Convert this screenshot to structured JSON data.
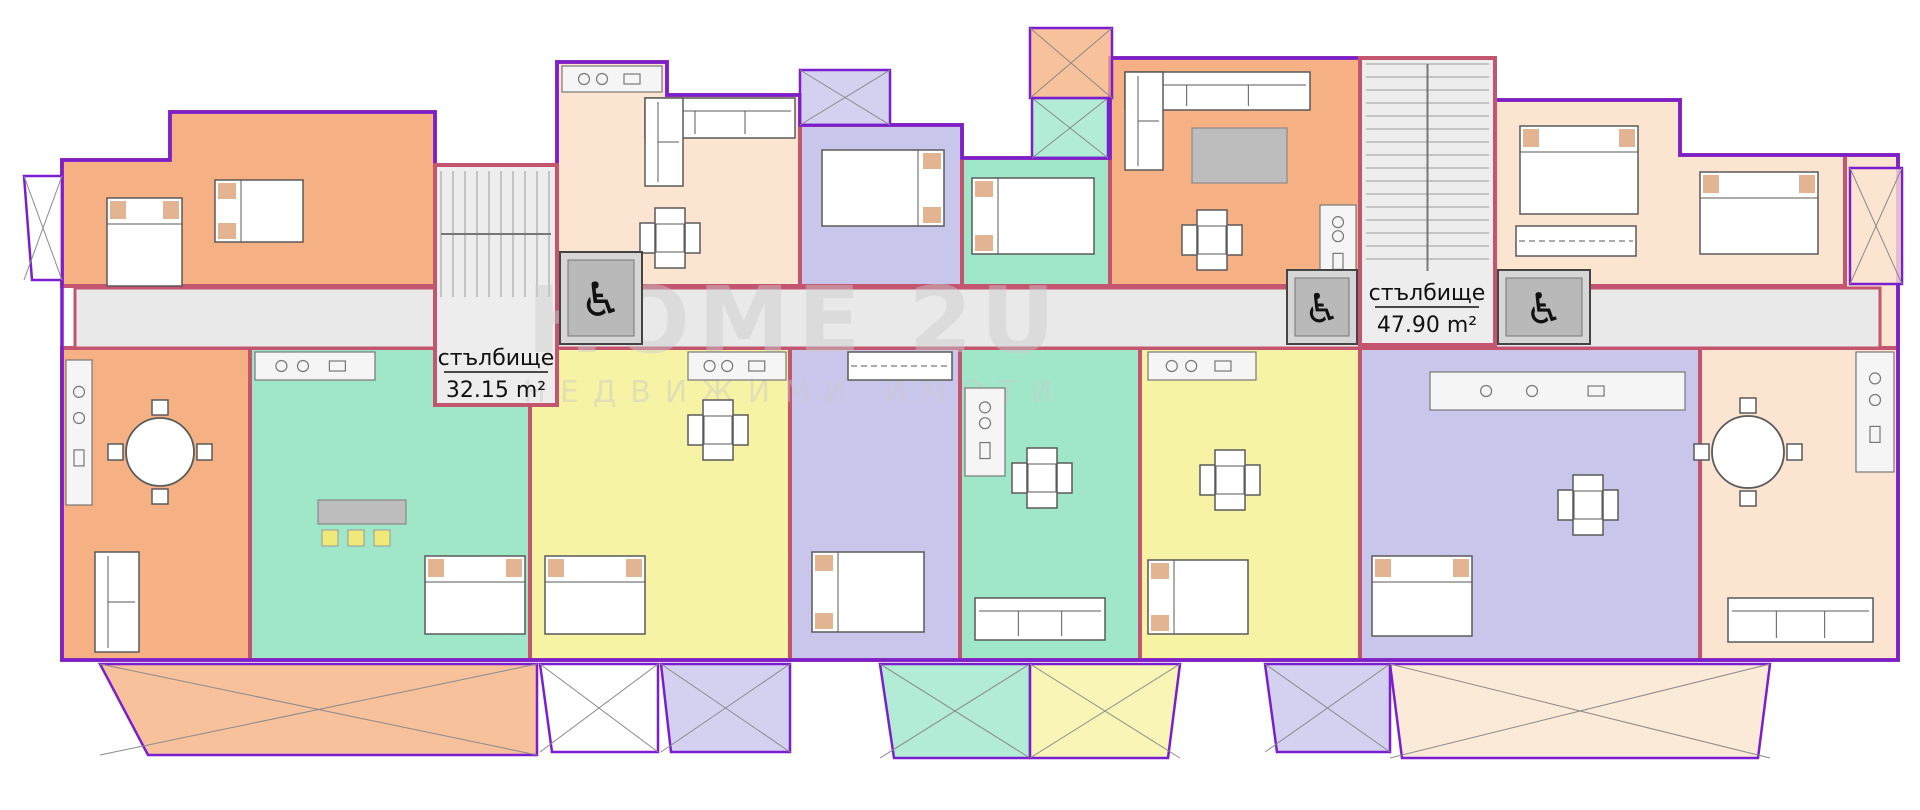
{
  "watermark": {
    "line1": "HOME 2U",
    "line2": "НЕДВИЖИМИ ИМОТИ"
  },
  "labels": {
    "staircase_left": {
      "name": "стълбище",
      "area": "32.15 m²"
    },
    "staircase_right": {
      "name": "стълбище",
      "area": "47.90 m²"
    }
  },
  "icons": {
    "wheelchair": "♿"
  },
  "colors": {
    "wall": "#c4556f",
    "outline": "#7a1fd0",
    "corridor": "#e9e9e9",
    "core": "#ededed",
    "tread": "#9a9a9a",
    "orange": "#f5b183",
    "cream": "#fbe5d0",
    "lavender": "#c9c6ec",
    "teal": "#a0e7c9",
    "yellow": "#f7f3a5",
    "white": "#ffffff",
    "elevator": "#d6d6d6",
    "elevator_inner": "#b9b9b9",
    "furniture_gray": "#bdbdbd",
    "chair_yellow": "#f0e97a"
  },
  "plan": {
    "outline": "M62,160 H170 V112 H435 V165 H557 V62 H667 V95 H800 V125 H962 V158 H1110 V58 H1495 V100 H1680 V155 H1898 V660 H62 Z",
    "corridor": {
      "name": "corridor",
      "points": "75,288 1880,288 1880,348 75,348"
    },
    "regions": [
      {
        "name": "apt-orange-top-left",
        "color": "orange",
        "points": "62,160 170,160 170,112 435,112 435,286 62,286"
      },
      {
        "name": "apt-cream-top-center",
        "color": "cream",
        "points": "557,62 667,62 667,95 800,95 800,286 557,286"
      },
      {
        "name": "apt-lavender-top-center",
        "color": "lavender",
        "points": "800,125 962,125 962,286 800,286"
      },
      {
        "name": "apt-teal-top-center",
        "color": "teal",
        "points": "962,158 1110,158 1110,286 962,286"
      },
      {
        "name": "apt-orange-top-right",
        "color": "orange",
        "points": "1110,58 1360,58 1360,286 1110,286"
      },
      {
        "name": "apt-cream-top-right",
        "color": "cream",
        "points": "1495,100 1680,100 1680,155 1845,155 1845,286 1495,286"
      },
      {
        "name": "apt-cream-right-wing",
        "color": "cream",
        "points": "1845,155 1898,155 1898,348 1845,348"
      },
      {
        "name": "apt-orange-bottom-left",
        "color": "orange",
        "points": "62,348 250,348 250,660 62,660"
      },
      {
        "name": "apt-teal-bottom-left",
        "color": "teal",
        "points": "250,348 530,348 530,660 250,660"
      },
      {
        "name": "apt-yellow-bottom-left",
        "color": "yellow",
        "points": "530,348 790,348 790,660 530,660"
      },
      {
        "name": "apt-lavender-bottom-center-left",
        "color": "lavender",
        "points": "790,348 960,348 960,660 790,660"
      },
      {
        "name": "apt-teal-bottom-center",
        "color": "teal",
        "points": "960,348 1140,348 1140,660 960,660"
      },
      {
        "name": "apt-yellow-bottom-center",
        "color": "yellow",
        "points": "1140,348 1360,348 1360,660 1140,660"
      },
      {
        "name": "apt-lavender-bottom-right",
        "color": "lavender",
        "points": "1360,348 1700,348 1700,660 1360,660"
      },
      {
        "name": "apt-cream-bottom-right",
        "color": "cream",
        "points": "1700,348 1898,348 1898,660 1700,660"
      }
    ],
    "balconies": [
      {
        "name": "balcony-orange-left",
        "color": "orange",
        "points": "100,664 537,664 537,755 148,755"
      },
      {
        "name": "balcony-white-1",
        "color": "white",
        "points": "540,664 658,664 658,752 552,752"
      },
      {
        "name": "balcony-lavender-1",
        "color": "lavender",
        "points": "661,664 790,664 790,752 671,752"
      },
      {
        "name": "balcony-teal-center",
        "color": "teal",
        "points": "880,664 1030,664 1030,758 894,758"
      },
      {
        "name": "balcony-yellow-center",
        "color": "yellow",
        "points": "1030,664 1180,664 1168,758 1030,758"
      },
      {
        "name": "balcony-lavender-2",
        "color": "lavender",
        "points": "1265,664 1390,664 1390,752 1277,752"
      },
      {
        "name": "balcony-cream-right",
        "color": "cream",
        "points": "1390,664 1770,664 1758,758 1402,758"
      },
      {
        "name": "terrace-lavender-top",
        "color": "lavender",
        "points": "800,70 890,70 890,125 800,125"
      },
      {
        "name": "terrace-teal-top",
        "color": "teal",
        "points": "1032,98 1108,98 1108,158 1032,158"
      },
      {
        "name": "terrace-orange-top",
        "color": "orange",
        "points": "1030,28 1112,28 1112,98 1030,98"
      },
      {
        "name": "balcony-cream-right-edge",
        "color": "cream",
        "points": "1850,168 1902,168 1902,284 1850,284"
      },
      {
        "name": "balcony-white-left-edge",
        "color": "white",
        "points": "24,176 62,176 62,280 32,280"
      }
    ],
    "cores": [
      {
        "name": "staircase-left",
        "x": 435,
        "y": 165,
        "w": 122,
        "h": 240,
        "stairs": {
          "x": 441,
          "y": 171,
          "w": 110,
          "h": 126,
          "dir": "v",
          "step": 12
        }
      },
      {
        "name": "staircase-right",
        "x": 1360,
        "y": 58,
        "w": 135,
        "h": 287,
        "stairs": {
          "x": 1366,
          "y": 64,
          "w": 123,
          "h": 207,
          "dir": "h",
          "step": 13
        }
      }
    ],
    "elevators": [
      {
        "name": "elevator-left",
        "x": 560,
        "y": 252,
        "w": 82,
        "h": 92
      },
      {
        "name": "elevator-right-1",
        "x": 1287,
        "y": 270,
        "w": 70,
        "h": 74
      },
      {
        "name": "elevator-right-2",
        "x": 1498,
        "y": 270,
        "w": 92,
        "h": 74
      }
    ],
    "furniture": [
      {
        "type": "bed",
        "x": 107,
        "y": 198,
        "w": 75,
        "h": 88,
        "head": "top"
      },
      {
        "type": "bed",
        "x": 215,
        "y": 180,
        "w": 88,
        "h": 62,
        "head": "left"
      },
      {
        "type": "bed",
        "x": 822,
        "y": 150,
        "w": 122,
        "h": 76,
        "head": "right"
      },
      {
        "type": "bed",
        "x": 972,
        "y": 178,
        "w": 122,
        "h": 76,
        "head": "left"
      },
      {
        "type": "bed",
        "x": 1520,
        "y": 126,
        "w": 118,
        "h": 88,
        "head": "top"
      },
      {
        "type": "bed",
        "x": 1700,
        "y": 172,
        "w": 118,
        "h": 82,
        "head": "top"
      },
      {
        "type": "bed",
        "x": 425,
        "y": 556,
        "w": 100,
        "h": 78,
        "head": "top"
      },
      {
        "type": "bed",
        "x": 545,
        "y": 556,
        "w": 100,
        "h": 78,
        "head": "top"
      },
      {
        "type": "bed",
        "x": 1148,
        "y": 560,
        "w": 100,
        "h": 74,
        "head": "left"
      },
      {
        "type": "bed",
        "x": 1372,
        "y": 556,
        "w": 100,
        "h": 80,
        "head": "top"
      },
      {
        "type": "bed",
        "x": 812,
        "y": 552,
        "w": 112,
        "h": 80,
        "head": "left"
      },
      {
        "type": "sofa",
        "x": 645,
        "y": 98,
        "w": 150,
        "h": 40
      },
      {
        "type": "sofa",
        "x": 645,
        "y": 98,
        "w": 38,
        "h": 88
      },
      {
        "type": "sofa",
        "x": 1125,
        "y": 72,
        "w": 185,
        "h": 38
      },
      {
        "type": "sofa",
        "x": 1125,
        "y": 72,
        "w": 38,
        "h": 98
      },
      {
        "type": "sofa",
        "x": 95,
        "y": 552,
        "w": 44,
        "h": 100
      },
      {
        "type": "sofa",
        "x": 975,
        "y": 598,
        "w": 130,
        "h": 42
      },
      {
        "type": "sofa",
        "x": 1728,
        "y": 598,
        "w": 145,
        "h": 44
      },
      {
        "type": "kitchen",
        "x": 562,
        "y": 66,
        "w": 100,
        "h": 26
      },
      {
        "type": "kitchen",
        "x": 1320,
        "y": 205,
        "w": 36,
        "h": 78
      },
      {
        "type": "kitchen",
        "x": 66,
        "y": 360,
        "w": 26,
        "h": 145
      },
      {
        "type": "kitchen",
        "x": 255,
        "y": 352,
        "w": 120,
        "h": 28
      },
      {
        "type": "kitchen",
        "x": 688,
        "y": 352,
        "w": 98,
        "h": 28
      },
      {
        "type": "kitchen",
        "x": 965,
        "y": 388,
        "w": 40,
        "h": 88
      },
      {
        "type": "kitchen",
        "x": 1148,
        "y": 352,
        "w": 108,
        "h": 28
      },
      {
        "type": "kitchen",
        "x": 1430,
        "y": 372,
        "w": 255,
        "h": 38
      },
      {
        "type": "kitchen",
        "x": 1856,
        "y": 352,
        "w": 38,
        "h": 120
      },
      {
        "type": "rtable",
        "cx": 160,
        "cy": 452,
        "r": 34
      },
      {
        "type": "rtable",
        "cx": 1748,
        "cy": 452,
        "r": 36
      },
      {
        "type": "xtable",
        "cx": 670,
        "cy": 238
      },
      {
        "type": "xtable",
        "cx": 1212,
        "cy": 240
      },
      {
        "type": "xtable",
        "cx": 1042,
        "cy": 478
      },
      {
        "type": "xtable",
        "cx": 1230,
        "cy": 480
      },
      {
        "type": "xtable",
        "cx": 1588,
        "cy": 505
      },
      {
        "type": "xtable",
        "cx": 718,
        "cy": 430
      },
      {
        "type": "ctable",
        "x": 1192,
        "y": 128,
        "w": 95,
        "h": 55
      },
      {
        "type": "ctable",
        "x": 318,
        "y": 500,
        "w": 88,
        "h": 24
      },
      {
        "type": "chairs3",
        "x": 322,
        "y": 530
      },
      {
        "type": "wardrobe",
        "x": 1516,
        "y": 226,
        "w": 120,
        "h": 30
      },
      {
        "type": "wardrobe",
        "x": 848,
        "y": 352,
        "w": 104,
        "h": 28
      }
    ]
  }
}
